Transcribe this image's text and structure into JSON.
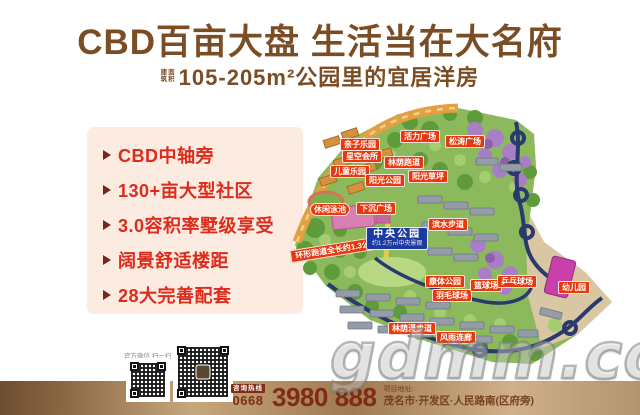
{
  "header": {
    "title": "CBD百亩大盘  生活当在大名府",
    "subtitle_prefix_line1": "建筑",
    "subtitle_prefix_line2": "面积",
    "subtitle": "105-205m²公园里的宜居洋房"
  },
  "features": {
    "items": [
      {
        "label": "CBD中轴旁"
      },
      {
        "label": "130+亩大型社区"
      },
      {
        "label": "3.0容积率墅级享受"
      },
      {
        "label": "阔景舒适楼距"
      },
      {
        "label": "28大完善配套"
      }
    ]
  },
  "map": {
    "labels": [
      {
        "text": "亲子乐园"
      },
      {
        "text": "活力广场"
      },
      {
        "text": "松涛广场"
      },
      {
        "text": "星空会所"
      },
      {
        "text": "林荫跑道"
      },
      {
        "text": "儿童乐园"
      },
      {
        "text": "阳光公园"
      },
      {
        "text": "阳光草坪"
      },
      {
        "text": "下沉广场"
      },
      {
        "text": "休闲泳池"
      },
      {
        "text": "滨水步道"
      },
      {
        "text": "康体公园"
      },
      {
        "text": "羽毛球场"
      },
      {
        "text": "篮球场"
      },
      {
        "text": "乒乓球场"
      },
      {
        "text": "幼儿园"
      },
      {
        "text": "风雨连廊"
      },
      {
        "text": "林荫漫步道"
      }
    ],
    "central_park": {
      "label": "中央公园",
      "sub": "约1.2万㎡中央景观"
    },
    "banner": {
      "text": "环形跑道全长约1.3公里"
    }
  },
  "watermark": "gdmm.com",
  "footer": {
    "qr_caption": "官方微信 扫一扫",
    "hotline_label": "咨询热线",
    "hotline_prefix": "0668",
    "hotline_number": "3980 888",
    "address_label": "项目地址:",
    "address": "茂名市·开发区·人民路南(区府旁)"
  },
  "colors": {
    "title_brown": "#7b4d24",
    "bullet_red": "#dd2b1c",
    "tag_red": "#e8380d",
    "park_blue": "#1d3aa2",
    "panel_pink": "#fcebe1",
    "maroon": "#7f2b16",
    "band_brown": "#a0794f"
  }
}
